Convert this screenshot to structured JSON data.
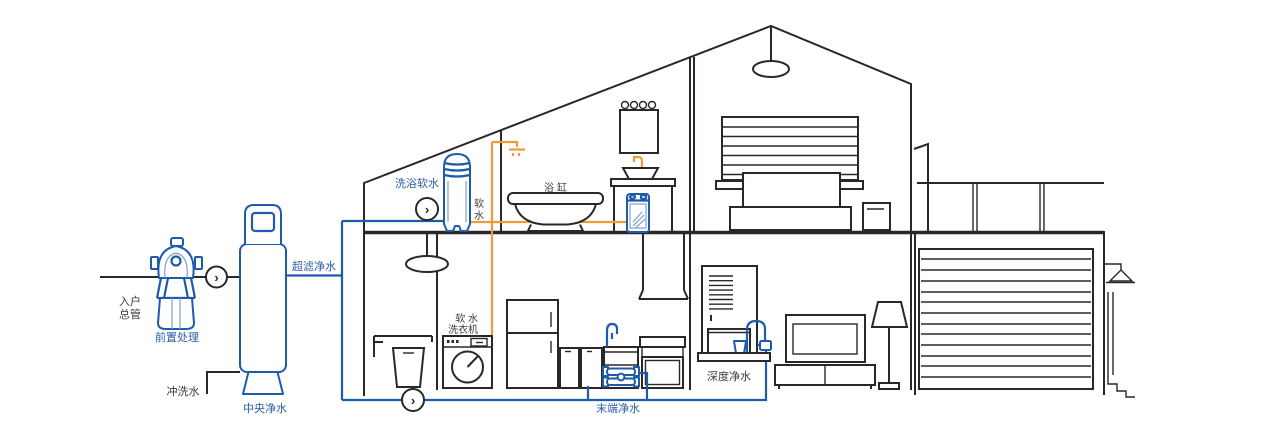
{
  "diagram": {
    "type": "home-water-purification-cutaway-house",
    "palette": {
      "pipe_blue": "#1f5bab",
      "pipe_orange": "#f09a3e",
      "outline_black": "#2b2728",
      "label_blue": "#2a5caa",
      "label_dark": "#3f3b3a"
    },
    "icons": {
      "flow_arrow": "›"
    },
    "labels": {
      "inlet_main_l1": "入户",
      "inlet_main_l2": "总管",
      "pre_treatment": "前置处理",
      "central_purifier": "中央净水",
      "flush_water": "冲洗水",
      "ultrafiltration": "超滤净水",
      "bath_softener": "洗浴软水",
      "soft_water_c1": "软",
      "soft_water_c2": "水",
      "bathtub": "浴缸",
      "soft_washer_l1": "软 水",
      "soft_washer_l2": "洗衣机",
      "terminal_purifier": "末端净水",
      "deep_purifier": "深度净水"
    }
  }
}
